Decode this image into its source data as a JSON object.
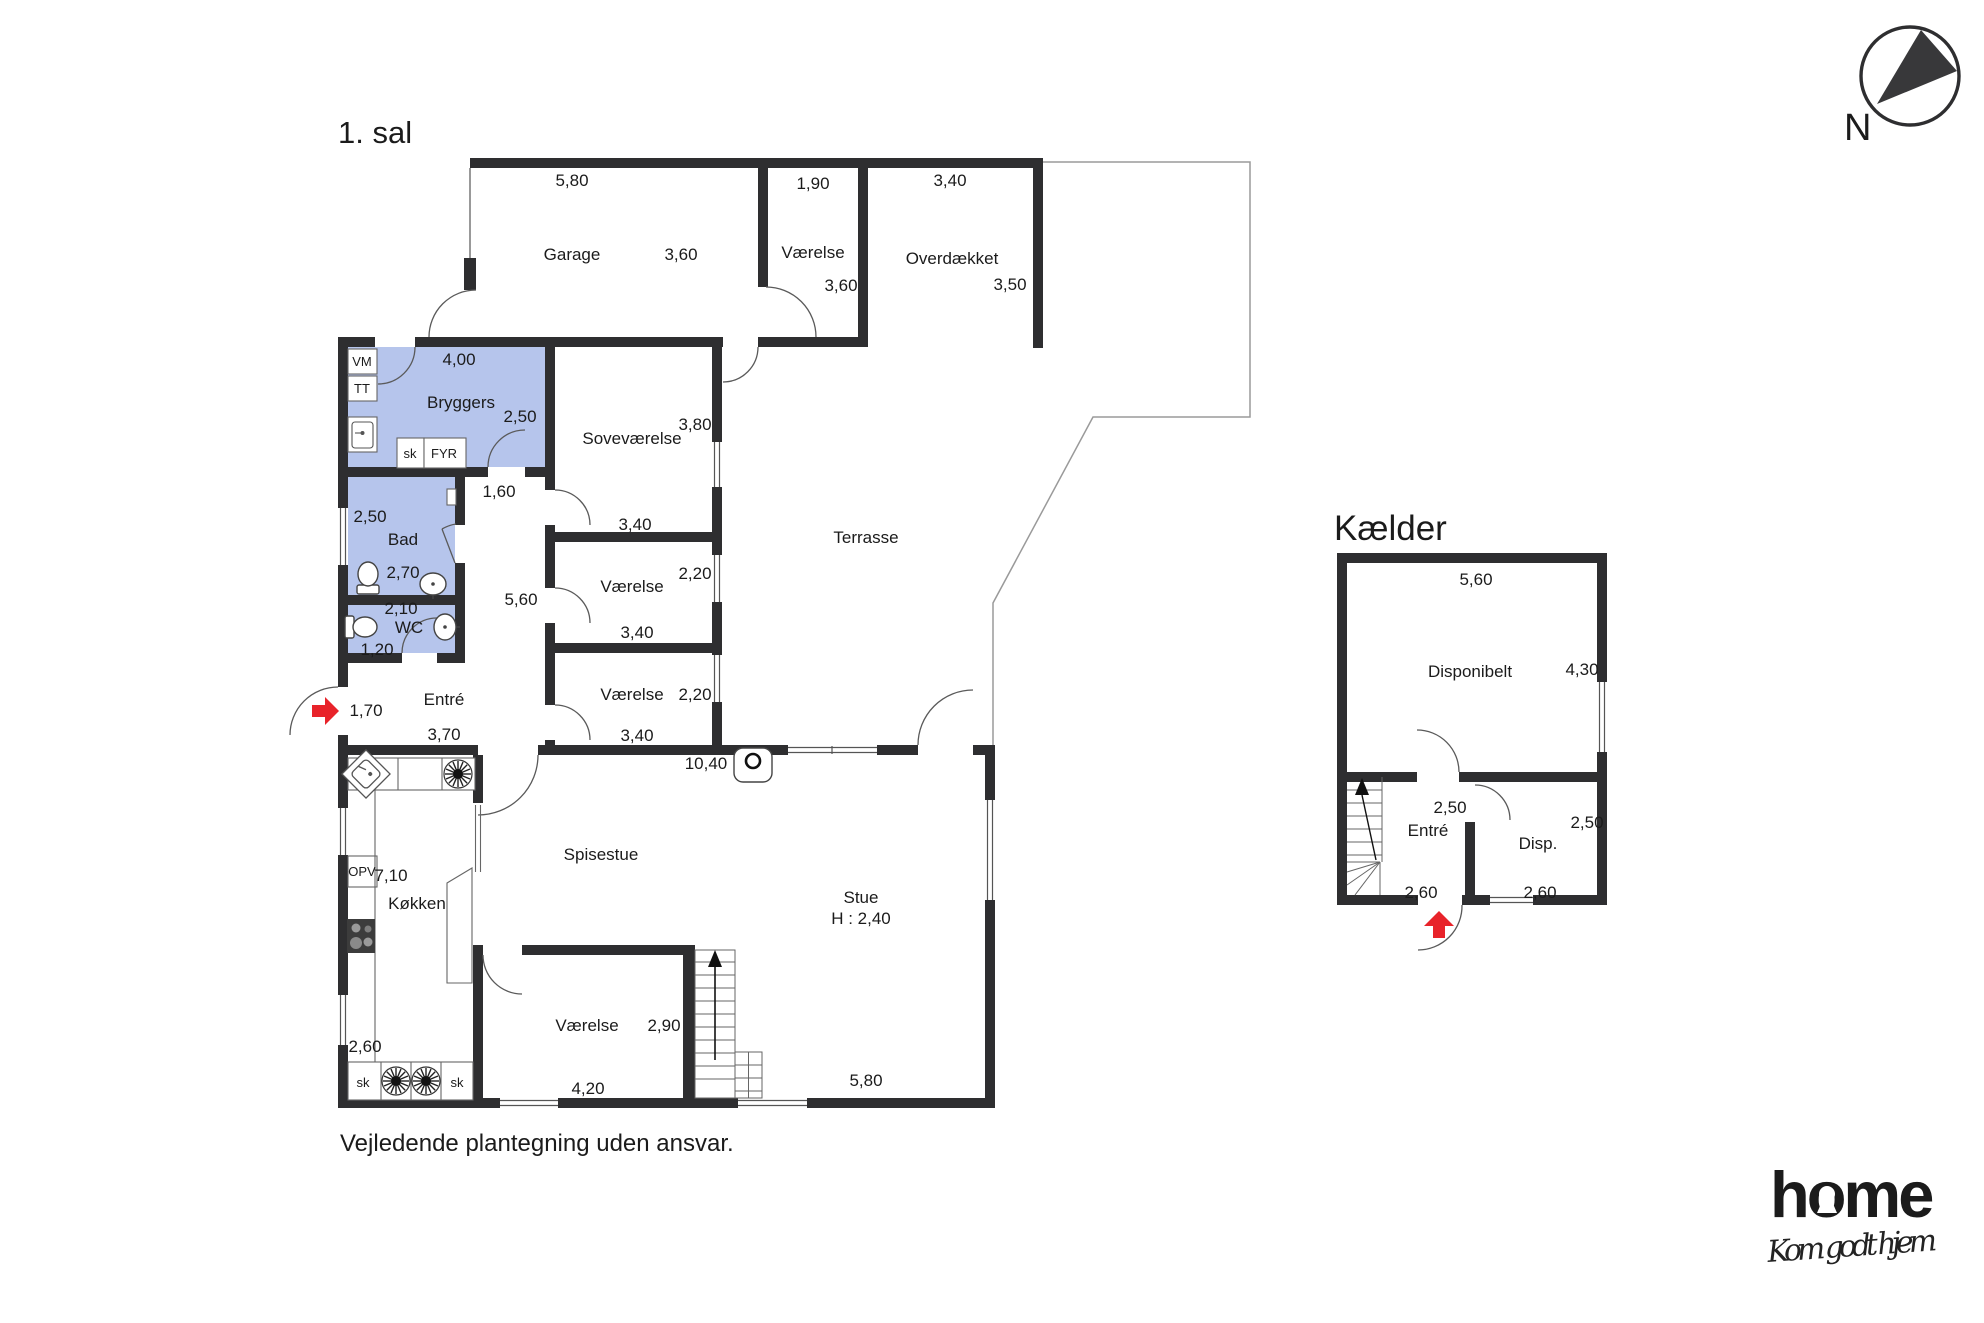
{
  "titles": {
    "first_floor": "1. sal",
    "basement": "Kælder",
    "north": "N",
    "disclaimer": "Vejledende plantegning uden ansvar."
  },
  "logo": {
    "brand": "home",
    "tagline": "Kom godt hjem",
    "brand_color": "#e8232a"
  },
  "colors": {
    "wall": "#2e2e30",
    "room_highlight": "#b6c5ec",
    "arrow_red": "#e8232a"
  },
  "first_floor": {
    "garage": {
      "label": "Garage",
      "w": "5,80",
      "h": "3,60"
    },
    "room_top": {
      "label": "Værelse",
      "w": "1,90",
      "h": "3,60"
    },
    "overdaekket": {
      "label": "Overdækket",
      "w": "3,40",
      "h": "3,50"
    },
    "bryggers": {
      "label": "Bryggers",
      "w": "4,00",
      "h": "2,50"
    },
    "hall": {
      "w": "1,60",
      "h": "5,60"
    },
    "sovevaerelse": {
      "label": "Soveværelse",
      "w": "3,40",
      "h": "3,80"
    },
    "terrasse": {
      "label": "Terrasse"
    },
    "bad": {
      "label": "Bad",
      "w": "2,50",
      "h": "2,70"
    },
    "wc": {
      "label": "WC",
      "w": "2,10",
      "h": "1,20"
    },
    "vaerelse_mid1": {
      "label": "Værelse",
      "w": "3,40",
      "h": "2,20"
    },
    "vaerelse_mid2": {
      "label": "Værelse",
      "w": "3,40",
      "h": "2,20"
    },
    "entre": {
      "label": "Entré",
      "w": "3,70",
      "h": "1,70"
    },
    "koekken": {
      "label": "Køkken",
      "w": "2,60",
      "h": "7,10"
    },
    "spisestue": {
      "label": "Spisestue",
      "w": "10,40"
    },
    "stue": {
      "label": "Stue",
      "ceiling_height": "H : 2,40",
      "w": "5,80"
    },
    "vaerelse_bottom": {
      "label": "Værelse",
      "w": "4,20",
      "h": "2,90"
    },
    "appliances": {
      "vm": "VM",
      "tt": "TT",
      "sk_bryggers": "sk",
      "fyr": "FYR",
      "opv": "OPV",
      "sk_left": "sk",
      "sk_right": "sk"
    }
  },
  "basement": {
    "disponibelt": {
      "label": "Disponibelt",
      "w": "5,60",
      "h": "4,30"
    },
    "entre": {
      "label": "Entré",
      "w": "2,60",
      "h": "2,50"
    },
    "disp": {
      "label": "Disp.",
      "w": "2,60",
      "h": "2,50"
    }
  }
}
